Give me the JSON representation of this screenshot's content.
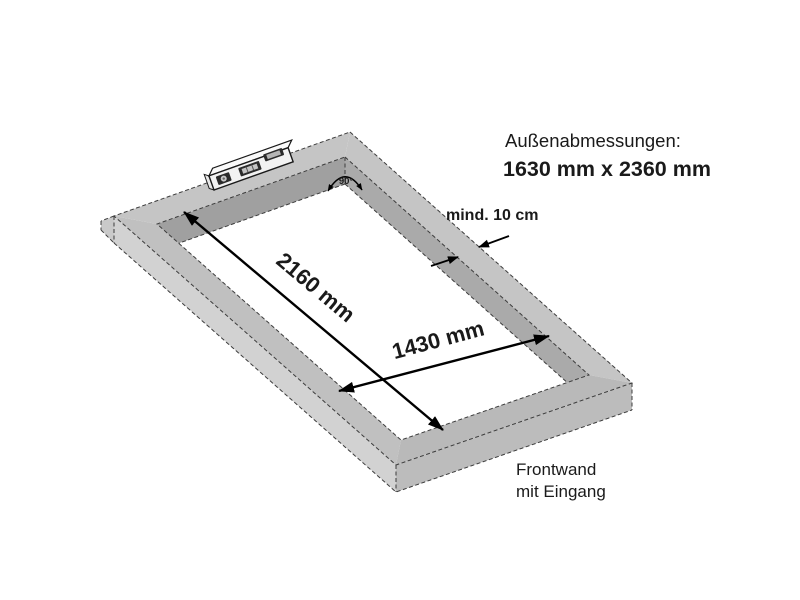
{
  "diagram": {
    "outer_dims": {
      "label": "Außenabmessungen:",
      "value": "1630 mm x 2360 mm"
    },
    "dim_long": "2160 mm",
    "dim_short": "1430 mm",
    "min_width": "mind. 10 cm",
    "angle": "90°",
    "front_wall": {
      "line1": "Frontwand",
      "line2": "mit Eingang"
    },
    "colors": {
      "background": "#ffffff",
      "frame_top": "#c5c5c5",
      "frame_inner_shadow": "#a0a0a0",
      "frame_face_light": "#d2d2d2",
      "frame_face_mid": "#bcbcbc",
      "line": "#000000",
      "text": "#1a1a1a"
    }
  }
}
